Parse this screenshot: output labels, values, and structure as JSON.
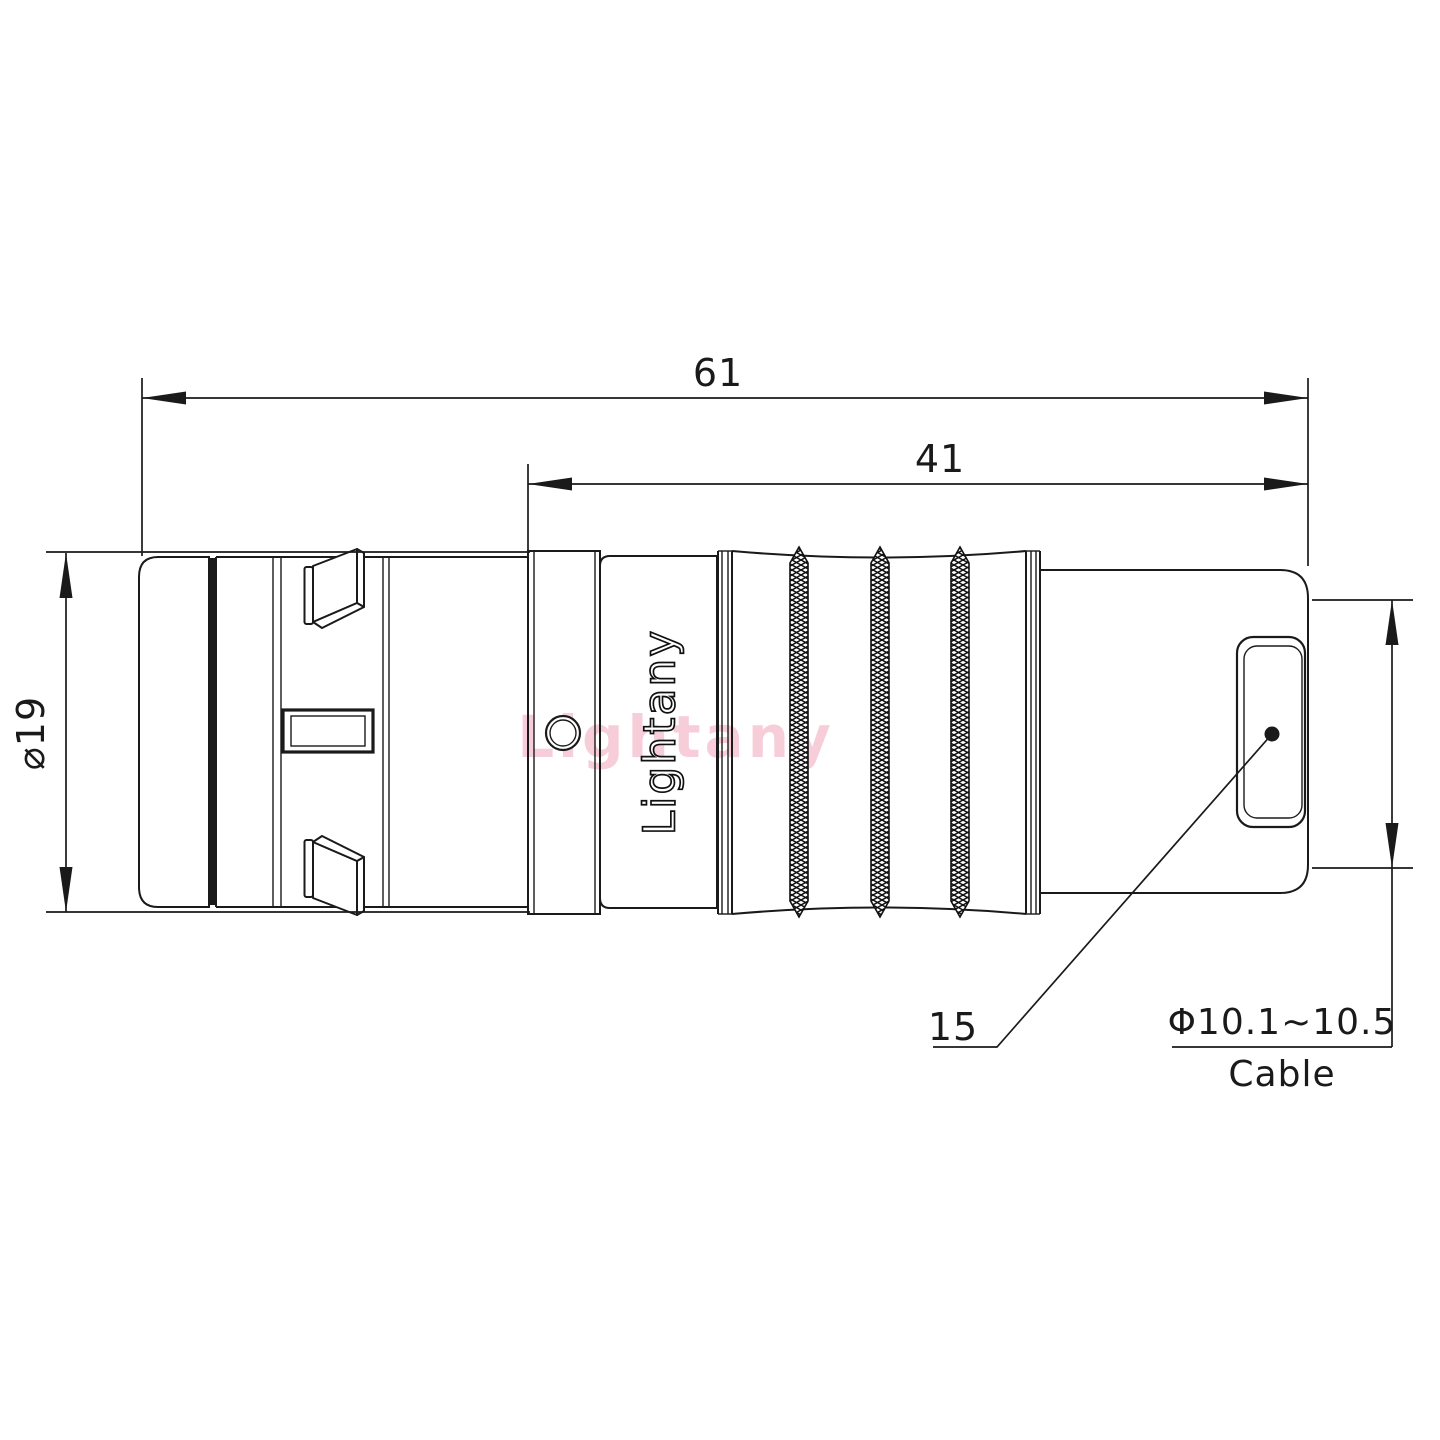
{
  "colors": {
    "background": "#ffffff",
    "line": "#1a1a1a",
    "watermark_pink": "#ee9db5"
  },
  "dimensions": {
    "overall_length": "61",
    "rear_section_length": "41",
    "body_diameter": "⌀19",
    "nut_length": "15",
    "cable_diameter_range": "Φ10.1~10.5",
    "cable_label": "Cable"
  },
  "branding": {
    "engraving": "Lightany",
    "watermark": "Lightany"
  }
}
